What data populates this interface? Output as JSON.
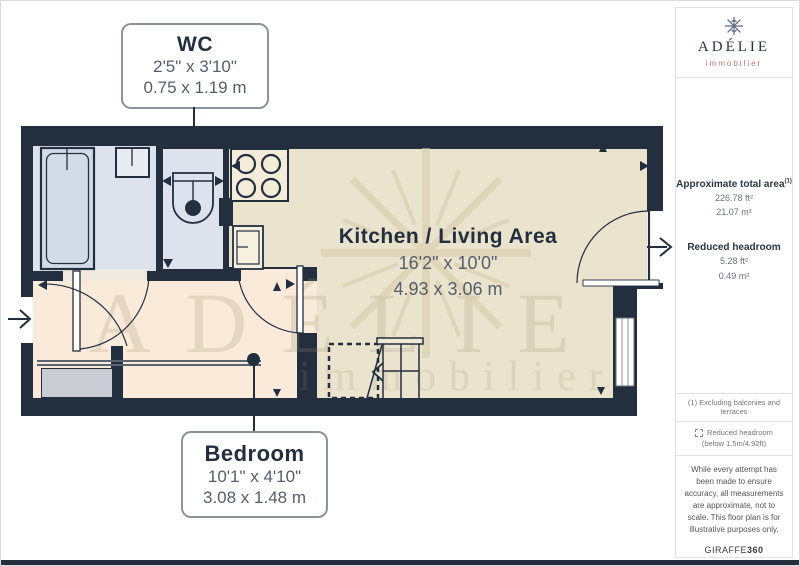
{
  "plan": {
    "labels": {
      "wc": {
        "title": "WC",
        "dims_ft": "2'5\" x 3'10\"",
        "dims_m": "0.75 x 1.19 m"
      },
      "kitchen": {
        "title": "Kitchen / Living Area",
        "dims_ft": "16'2\" x 10'0\"",
        "dims_m": "4.93 x 3.06 m"
      },
      "bedroom": {
        "title": "Bedroom",
        "dims_ft": "10'1\" x 4'10\"",
        "dims_m": "3.08 x 1.48 m"
      }
    },
    "watermark": {
      "text": "ADÉLIE",
      "subtext": "immobilier"
    }
  },
  "sidebar": {
    "logo": {
      "brand": "ADÉLIE",
      "tagline": "immobilier"
    },
    "area": {
      "total_label": "Approximate total area",
      "total_sup": "(1)",
      "total_ft": "226.78 ft²",
      "total_m": "21.07 m²",
      "headroom_label": "Reduced headroom",
      "headroom_ft": "5.28 ft²",
      "headroom_m": "0.49 m²"
    },
    "note": "(1) Excluding balconies and terraces",
    "legend": {
      "label": "Reduced headroom",
      "sub": "(below 1.5m/4.92ft)"
    },
    "disclaimer": "While every attempt has been made to ensure accuracy, all measurements are approximate, not to scale. This floor plan is for illustrative purposes only.",
    "brand": {
      "name": "GIRAFFE",
      "suffix": "360"
    }
  },
  "colors": {
    "wall": "#232e3f",
    "kitchen_floor": "#eae3cd",
    "bedroom_floor": "#f9ead9",
    "bathroom_floor": "#dde2ec",
    "tagline_accent": "#c0776b"
  }
}
